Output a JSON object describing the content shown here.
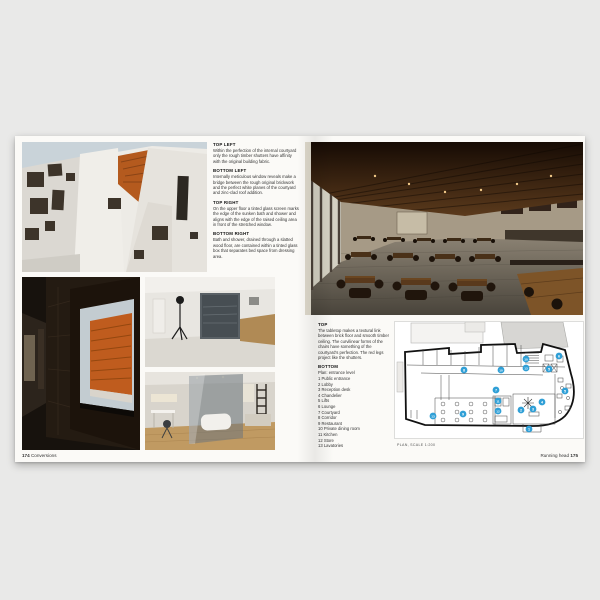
{
  "colors": {
    "marker_blue": "#2f9fd6",
    "accent_orange": "#bc5c1d",
    "page_white": "#fbfaf7",
    "background_gray": "#e9e9e8"
  },
  "left_page": {
    "captions": [
      {
        "heading": "TOP LEFT",
        "body": "Within the perfection of the internal courtyard only the rough timber shutters have affinity with the original building fabric."
      },
      {
        "heading": "BOTTOM LEFT",
        "body": "Internally meticulous window reveals make a bridge between the rough original brickwork and the perfect white planes of the courtyard and zinc-clad roof addition."
      },
      {
        "heading": "TOP RIGHT",
        "body": "On the upper floor a tinted glass screen marks the edge of the sunken bath and shower and aligns with the edge of the raised ceiling area in front of the stretched window."
      },
      {
        "heading": "BOTTOM RIGHT",
        "body": "Bath and shower, drained through a slatted wood floor, are contained within a tinted glass box that separates bed space from dressing area."
      }
    ],
    "footer": {
      "page_number": "174",
      "section": "Conversions"
    }
  },
  "right_page": {
    "caption_top": {
      "heading": "TOP",
      "body": "The tabletop makes a textural link between brick floor and smooth timber ceiling. The curvilinear forms of the chairs have something of the courtyard's perfection. The red legs project like the shutters."
    },
    "legend": {
      "heading": "BOTTOM",
      "title": "Plan: entrance level",
      "items": [
        "1 Public entrance",
        "2 Lobby",
        "3 Reception desk",
        "4 Chandelier",
        "5 Lifts",
        "6 Lounge",
        "7 Courtyard",
        "8 Corridor",
        "9 Restaurant",
        "10 Private dining room",
        "11 Kitchen",
        "12 Store",
        "13 Lavatories"
      ]
    },
    "plan": {
      "caption": "PLAN, SCALE 1:200",
      "markers": [
        {
          "n": "1",
          "x": 134,
          "y": 107
        },
        {
          "n": "2",
          "x": 126,
          "y": 88
        },
        {
          "n": "3",
          "x": 138,
          "y": 87
        },
        {
          "n": "4",
          "x": 147,
          "y": 80
        },
        {
          "n": "5",
          "x": 154,
          "y": 47
        },
        {
          "n": "5",
          "x": 170,
          "y": 69
        },
        {
          "n": "6",
          "x": 164,
          "y": 34
        },
        {
          "n": "7",
          "x": 101,
          "y": 68
        },
        {
          "n": "8",
          "x": 69,
          "y": 48
        },
        {
          "n": "9",
          "x": 68,
          "y": 92
        },
        {
          "n": "10",
          "x": 106,
          "y": 48
        },
        {
          "n": "10",
          "x": 131,
          "y": 37
        },
        {
          "n": "11",
          "x": 103,
          "y": 79
        },
        {
          "n": "12",
          "x": 103,
          "y": 89
        },
        {
          "n": "13",
          "x": 38,
          "y": 94
        },
        {
          "n": "13",
          "x": 131,
          "y": 46
        }
      ]
    },
    "footer": {
      "running_head": "Running head",
      "page_number": "175"
    }
  }
}
